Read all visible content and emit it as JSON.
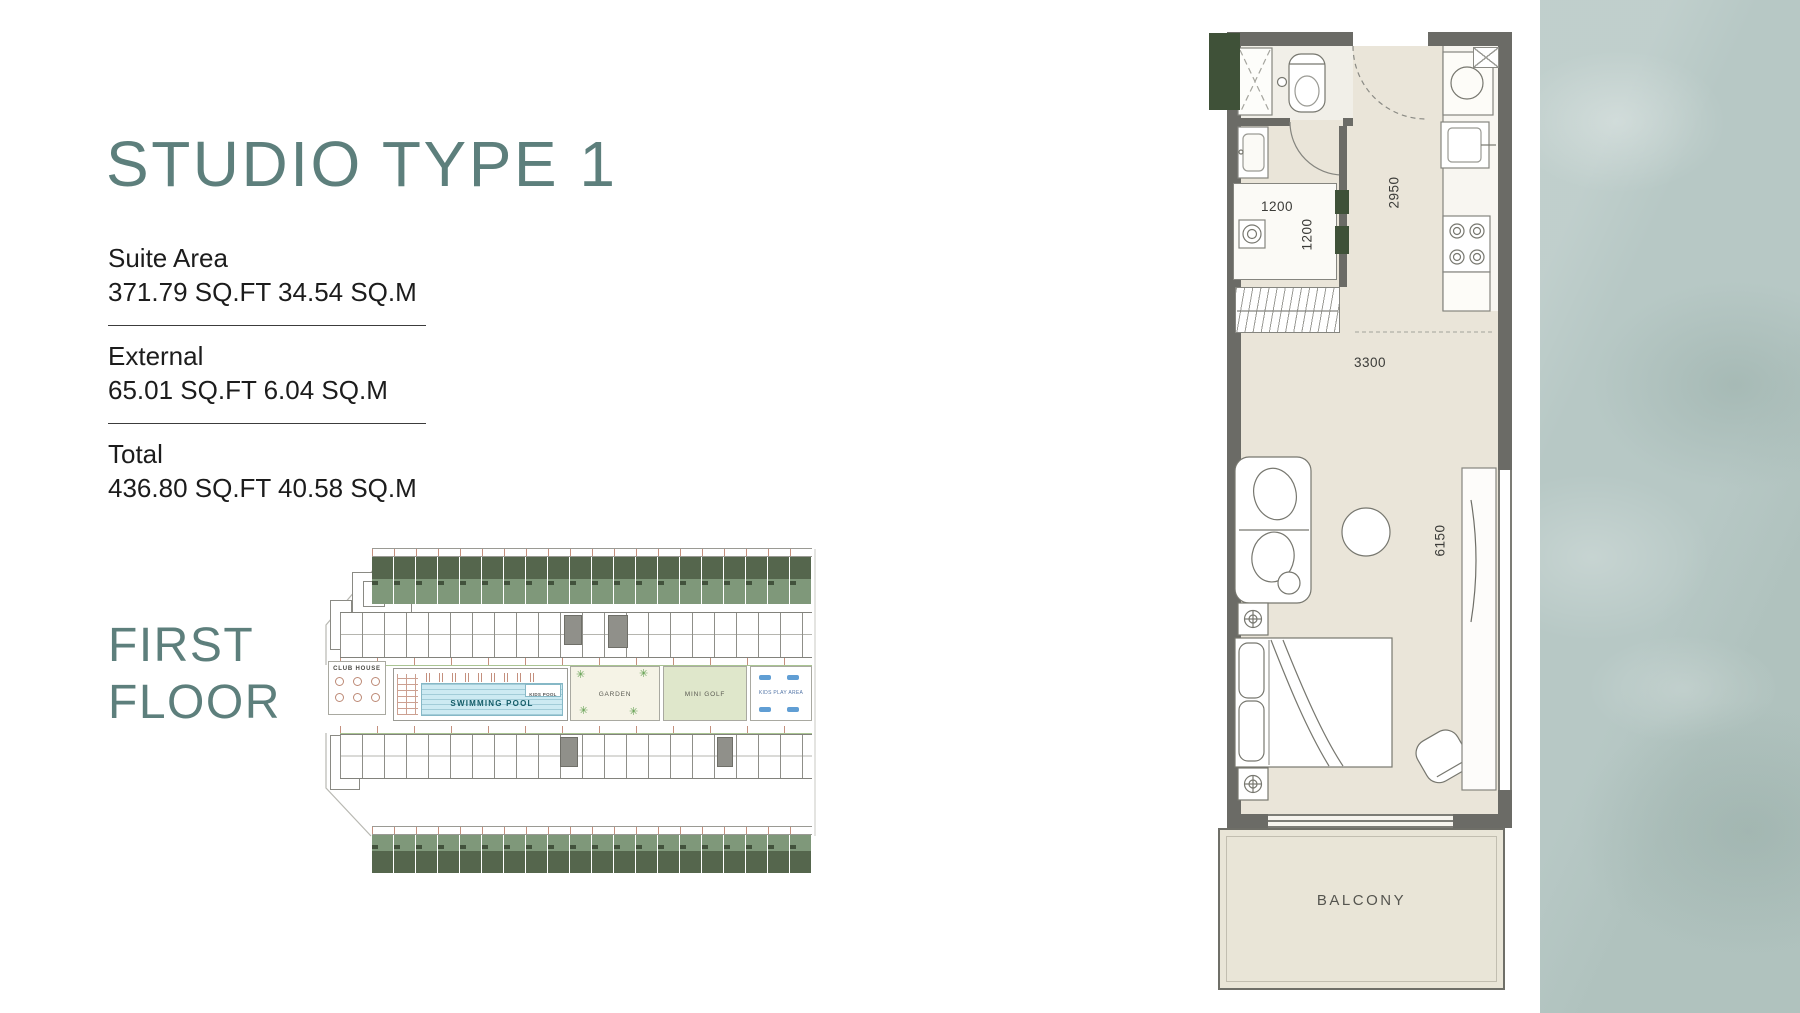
{
  "page": {
    "title": "STUDIO TYPE 1",
    "floor_line1": "FIRST",
    "floor_line2": "FLOOR"
  },
  "areas": {
    "suite_label": "Suite Area",
    "suite_value": "371.79 SQ.FT 34.54 SQ.M",
    "external_label": "External",
    "external_value": "65.01 SQ.FT 6.04 SQ.M",
    "total_label": "Total",
    "total_value": "436.80 SQ.FT 40.58 SQ.M"
  },
  "site_plan": {
    "club_house": "CLUB HOUSE",
    "swimming_pool": "SWIMMING POOL",
    "kids_pool": "KIDS POOL",
    "garden": "GARDEN",
    "mini_golf": "MINI GOLF",
    "kids_play_area": "KIDS PLAY AREA"
  },
  "floor_plan": {
    "dim_closet_width": "1200",
    "dim_closet_depth": "1200",
    "dim_entry_depth": "2950",
    "dim_room_width": "3300",
    "dim_room_length": "6150",
    "balcony_label": "BALCONY"
  },
  "colors": {
    "accent_teal": "#5d7f7c",
    "text_dark": "#1c1c1c",
    "band_sage": "#b7c8c5",
    "plan_wall": "#6b6b66",
    "plan_floor": "#eae5d9",
    "plan_green": "#3f5138",
    "site_green_light": "#7f987a",
    "site_green_dark": "#55664d",
    "pool_blue": "#cdeaf2"
  }
}
